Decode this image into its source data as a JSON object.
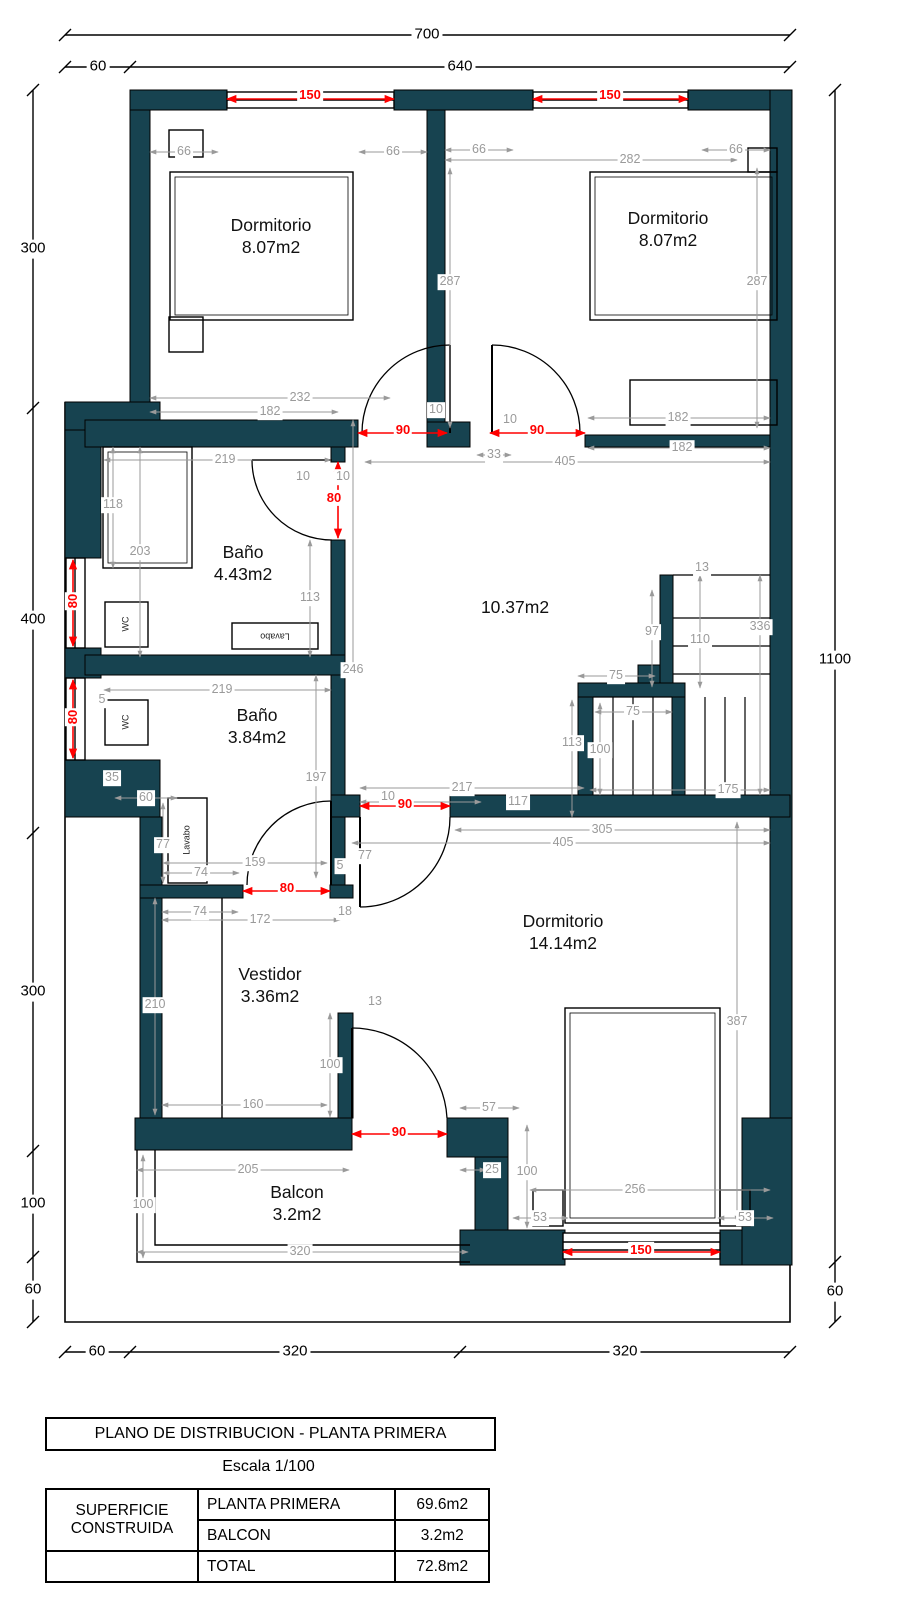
{
  "colors": {
    "wall": "#174350",
    "dim_gray": "#9a9a9a",
    "dim_red": "#ff0000"
  },
  "plan": {
    "rooms": [
      {
        "name": "Dormitorio",
        "area": "8.07m2"
      },
      {
        "name": "Dormitorio",
        "area": "8.07m2"
      },
      {
        "name": "Baño",
        "area": "4.43m2"
      },
      {
        "name": "Hall",
        "area": "10.37m2"
      },
      {
        "name": "Baño",
        "area": "3.84m2"
      },
      {
        "name": "Vestidor",
        "area": "3.36m2"
      },
      {
        "name": "Dormitorio",
        "area": "14.14m2"
      },
      {
        "name": "Balcon",
        "area": "3.2m2"
      }
    ],
    "labels": [
      {
        "t": "700",
        "x": 427,
        "y": 35,
        "c": "k"
      },
      {
        "t": "60",
        "x": 98,
        "y": 67,
        "c": "k"
      },
      {
        "t": "640",
        "x": 460,
        "y": 67,
        "c": "k"
      },
      {
        "t": "300",
        "x": 33,
        "y": 249,
        "c": "k"
      },
      {
        "t": "400",
        "x": 33,
        "y": 620,
        "c": "k"
      },
      {
        "t": "300",
        "x": 33,
        "y": 992,
        "c": "k"
      },
      {
        "t": "100",
        "x": 33,
        "y": 1204,
        "c": "k"
      },
      {
        "t": "60",
        "x": 33,
        "y": 1290,
        "c": "k"
      },
      {
        "t": "1100",
        "x": 835,
        "y": 660,
        "c": "k"
      },
      {
        "t": "60",
        "x": 835,
        "y": 1292,
        "c": "k"
      },
      {
        "t": "60",
        "x": 97,
        "y": 1352,
        "c": "k"
      },
      {
        "t": "320",
        "x": 295,
        "y": 1352,
        "c": "k"
      },
      {
        "t": "320",
        "x": 625,
        "y": 1352,
        "c": "k"
      },
      {
        "t": "150",
        "x": 310,
        "y": 95,
        "c": "r"
      },
      {
        "t": "150",
        "x": 610,
        "y": 95,
        "c": "r"
      },
      {
        "t": "90",
        "x": 403,
        "y": 430,
        "c": "r"
      },
      {
        "t": "90",
        "x": 537,
        "y": 430,
        "c": "r"
      },
      {
        "t": "80",
        "x": 334,
        "y": 498,
        "c": "r"
      },
      {
        "t": "80",
        "x": 73,
        "y": 601,
        "c": "r",
        "r": -90
      },
      {
        "t": "80",
        "x": 73,
        "y": 717,
        "c": "r",
        "r": -90
      },
      {
        "t": "80",
        "x": 287,
        "y": 888,
        "c": "r"
      },
      {
        "t": "90",
        "x": 405,
        "y": 804,
        "c": "r"
      },
      {
        "t": "90",
        "x": 399,
        "y": 1132,
        "c": "r"
      },
      {
        "t": "150",
        "x": 641,
        "y": 1250,
        "c": "r"
      },
      {
        "t": "66",
        "x": 184,
        "y": 152,
        "c": "g"
      },
      {
        "t": "66",
        "x": 393,
        "y": 152,
        "c": "g"
      },
      {
        "t": "66",
        "x": 479,
        "y": 150,
        "c": "g"
      },
      {
        "t": "282",
        "x": 630,
        "y": 160,
        "c": "g"
      },
      {
        "t": "66",
        "x": 736,
        "y": 150,
        "c": "g"
      },
      {
        "t": "287",
        "x": 450,
        "y": 282,
        "c": "g"
      },
      {
        "t": "287",
        "x": 757,
        "y": 282,
        "c": "g"
      },
      {
        "t": "232",
        "x": 300,
        "y": 398,
        "c": "g"
      },
      {
        "t": "182",
        "x": 270,
        "y": 412,
        "c": "g"
      },
      {
        "t": "182",
        "x": 678,
        "y": 418,
        "c": "g"
      },
      {
        "t": "182",
        "x": 682,
        "y": 448,
        "c": "g"
      },
      {
        "t": "405",
        "x": 565,
        "y": 462,
        "c": "g"
      },
      {
        "t": "33",
        "x": 494,
        "y": 455,
        "c": "g"
      },
      {
        "t": "10",
        "x": 436,
        "y": 410,
        "c": "g"
      },
      {
        "t": "10",
        "x": 510,
        "y": 420,
        "c": "g"
      },
      {
        "t": "10",
        "x": 303,
        "y": 477,
        "c": "g"
      },
      {
        "t": "10",
        "x": 343,
        "y": 477,
        "c": "g"
      },
      {
        "t": "219",
        "x": 225,
        "y": 460,
        "c": "g"
      },
      {
        "t": "118",
        "x": 113,
        "y": 505,
        "c": "g"
      },
      {
        "t": "203",
        "x": 140,
        "y": 552,
        "c": "g"
      },
      {
        "t": "113",
        "x": 310,
        "y": 598,
        "c": "g"
      },
      {
        "t": "246",
        "x": 353,
        "y": 670,
        "c": "g"
      },
      {
        "t": "219",
        "x": 222,
        "y": 690,
        "c": "g"
      },
      {
        "t": "5",
        "x": 102,
        "y": 700,
        "c": "g"
      },
      {
        "t": "35",
        "x": 112,
        "y": 778,
        "c": "g"
      },
      {
        "t": "60",
        "x": 146,
        "y": 798,
        "c": "g"
      },
      {
        "t": "197",
        "x": 316,
        "y": 778,
        "c": "g"
      },
      {
        "t": "77",
        "x": 163,
        "y": 845,
        "c": "g"
      },
      {
        "t": "159",
        "x": 255,
        "y": 863,
        "c": "g"
      },
      {
        "t": "74",
        "x": 201,
        "y": 873,
        "c": "g"
      },
      {
        "t": "5",
        "x": 340,
        "y": 866,
        "c": "g"
      },
      {
        "t": "77",
        "x": 365,
        "y": 856,
        "c": "g"
      },
      {
        "t": "74",
        "x": 200,
        "y": 912,
        "c": "g"
      },
      {
        "t": "172",
        "x": 260,
        "y": 920,
        "c": "g"
      },
      {
        "t": "18",
        "x": 345,
        "y": 912,
        "c": "g"
      },
      {
        "t": "210",
        "x": 155,
        "y": 1005,
        "c": "g"
      },
      {
        "t": "13",
        "x": 375,
        "y": 1002,
        "c": "g"
      },
      {
        "t": "100",
        "x": 330,
        "y": 1065,
        "c": "g"
      },
      {
        "t": "160",
        "x": 253,
        "y": 1105,
        "c": "g"
      },
      {
        "t": "13",
        "x": 702,
        "y": 568,
        "c": "g"
      },
      {
        "t": "97",
        "x": 652,
        "y": 632,
        "c": "g"
      },
      {
        "t": "110",
        "x": 700,
        "y": 640,
        "c": "g"
      },
      {
        "t": "336",
        "x": 760,
        "y": 627,
        "c": "g"
      },
      {
        "t": "75",
        "x": 616,
        "y": 676,
        "c": "g"
      },
      {
        "t": "75",
        "x": 633,
        "y": 712,
        "c": "g"
      },
      {
        "t": "113",
        "x": 572,
        "y": 743,
        "c": "g"
      },
      {
        "t": "100",
        "x": 600,
        "y": 750,
        "c": "g"
      },
      {
        "t": "175",
        "x": 728,
        "y": 790,
        "c": "g"
      },
      {
        "t": "217",
        "x": 462,
        "y": 788,
        "c": "g"
      },
      {
        "t": "117",
        "x": 518,
        "y": 802,
        "c": "g"
      },
      {
        "t": "10",
        "x": 388,
        "y": 797,
        "c": "g"
      },
      {
        "t": "305",
        "x": 602,
        "y": 830,
        "c": "g"
      },
      {
        "t": "405",
        "x": 563,
        "y": 843,
        "c": "g"
      },
      {
        "t": "387",
        "x": 737,
        "y": 1022,
        "c": "g"
      },
      {
        "t": "57",
        "x": 489,
        "y": 1108,
        "c": "g"
      },
      {
        "t": "205",
        "x": 248,
        "y": 1170,
        "c": "g"
      },
      {
        "t": "25",
        "x": 492,
        "y": 1170,
        "c": "g"
      },
      {
        "t": "100",
        "x": 143,
        "y": 1205,
        "c": "g"
      },
      {
        "t": "320",
        "x": 300,
        "y": 1252,
        "c": "g"
      },
      {
        "t": "100",
        "x": 527,
        "y": 1172,
        "c": "g"
      },
      {
        "t": "256",
        "x": 635,
        "y": 1190,
        "c": "g"
      },
      {
        "t": "53",
        "x": 540,
        "y": 1218,
        "c": "g"
      },
      {
        "t": "53",
        "x": 745,
        "y": 1218,
        "c": "g"
      },
      {
        "t": "Dormitorio\n8.07m2",
        "x": 271,
        "y": 237,
        "c": "room"
      },
      {
        "t": "Dormitorio\n8.07m2",
        "x": 668,
        "y": 230,
        "c": "room"
      },
      {
        "t": "Baño\n4.43m2",
        "x": 243,
        "y": 564,
        "c": "room"
      },
      {
        "t": "10.37m2",
        "x": 515,
        "y": 608,
        "c": "room"
      },
      {
        "t": "Baño\n3.84m2",
        "x": 257,
        "y": 727,
        "c": "room"
      },
      {
        "t": "Vestidor\n3.36m2",
        "x": 270,
        "y": 986,
        "c": "room"
      },
      {
        "t": "Dormitorio\n14.14m2",
        "x": 563,
        "y": 933,
        "c": "room"
      },
      {
        "t": "Balcon\n3.2m2",
        "x": 297,
        "y": 1204,
        "c": "room"
      },
      {
        "t": "WC",
        "x": 126,
        "y": 624,
        "c": "fx",
        "r": -90
      },
      {
        "t": "WC",
        "x": 126,
        "y": 722,
        "c": "fx",
        "r": -90
      },
      {
        "t": "Lavabo",
        "x": 275,
        "y": 636,
        "c": "fx",
        "r": 180
      },
      {
        "t": "Lavabo",
        "x": 187,
        "y": 840,
        "c": "fx",
        "r": -90
      }
    ]
  },
  "footer": {
    "title": "PLANO DE DISTRIBUCION - PLANTA PRIMERA",
    "scale": "Escala 1/100",
    "table": {
      "header": "SUPERFICIE CONSTRUIDA",
      "rows": [
        {
          "name": "PLANTA PRIMERA",
          "value": "69.6m2"
        },
        {
          "name": "BALCON",
          "value": "3.2m2"
        },
        {
          "name": "TOTAL",
          "value": "72.8m2"
        }
      ]
    }
  }
}
